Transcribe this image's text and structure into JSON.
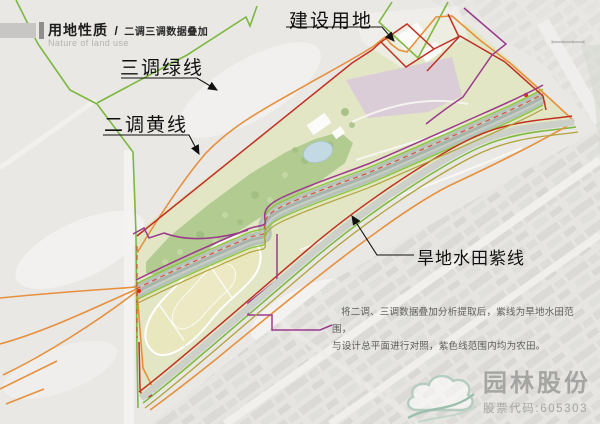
{
  "header": {
    "title": "用地性质",
    "separator": "/",
    "subtitle": "二调三调数据叠加",
    "subtitle_en": "Nature of land use"
  },
  "map": {
    "lines": [
      {
        "label": "三调绿线",
        "color": "#7cb83e"
      },
      {
        "label": "建设用地",
        "color": "#c22f23"
      },
      {
        "label": "二调黄线",
        "color": "#e6903c"
      },
      {
        "label": "旱地水田紫线",
        "color": "#9b3a8c"
      }
    ],
    "colors": {
      "aerial_background": "#e9e8e5",
      "site_fill": "#e2e6c2",
      "forest": "#b2cb91",
      "river_corridor": "#b6c2b8",
      "field_loop": "#e9e7bd",
      "lavender_zone": "#d8c7dc",
      "olive_line": "#b2a23c",
      "red_dashed_line": "#d8503a"
    }
  },
  "annotation": {
    "line1": "将二调、三调数据叠加分析提取后，紫线为旱地水田范围，",
    "line2": "与设计总平面进行对照，紫色线范围内均为农田。"
  },
  "logo": {
    "company": "园林股份",
    "stock": "股票代码:605303"
  }
}
